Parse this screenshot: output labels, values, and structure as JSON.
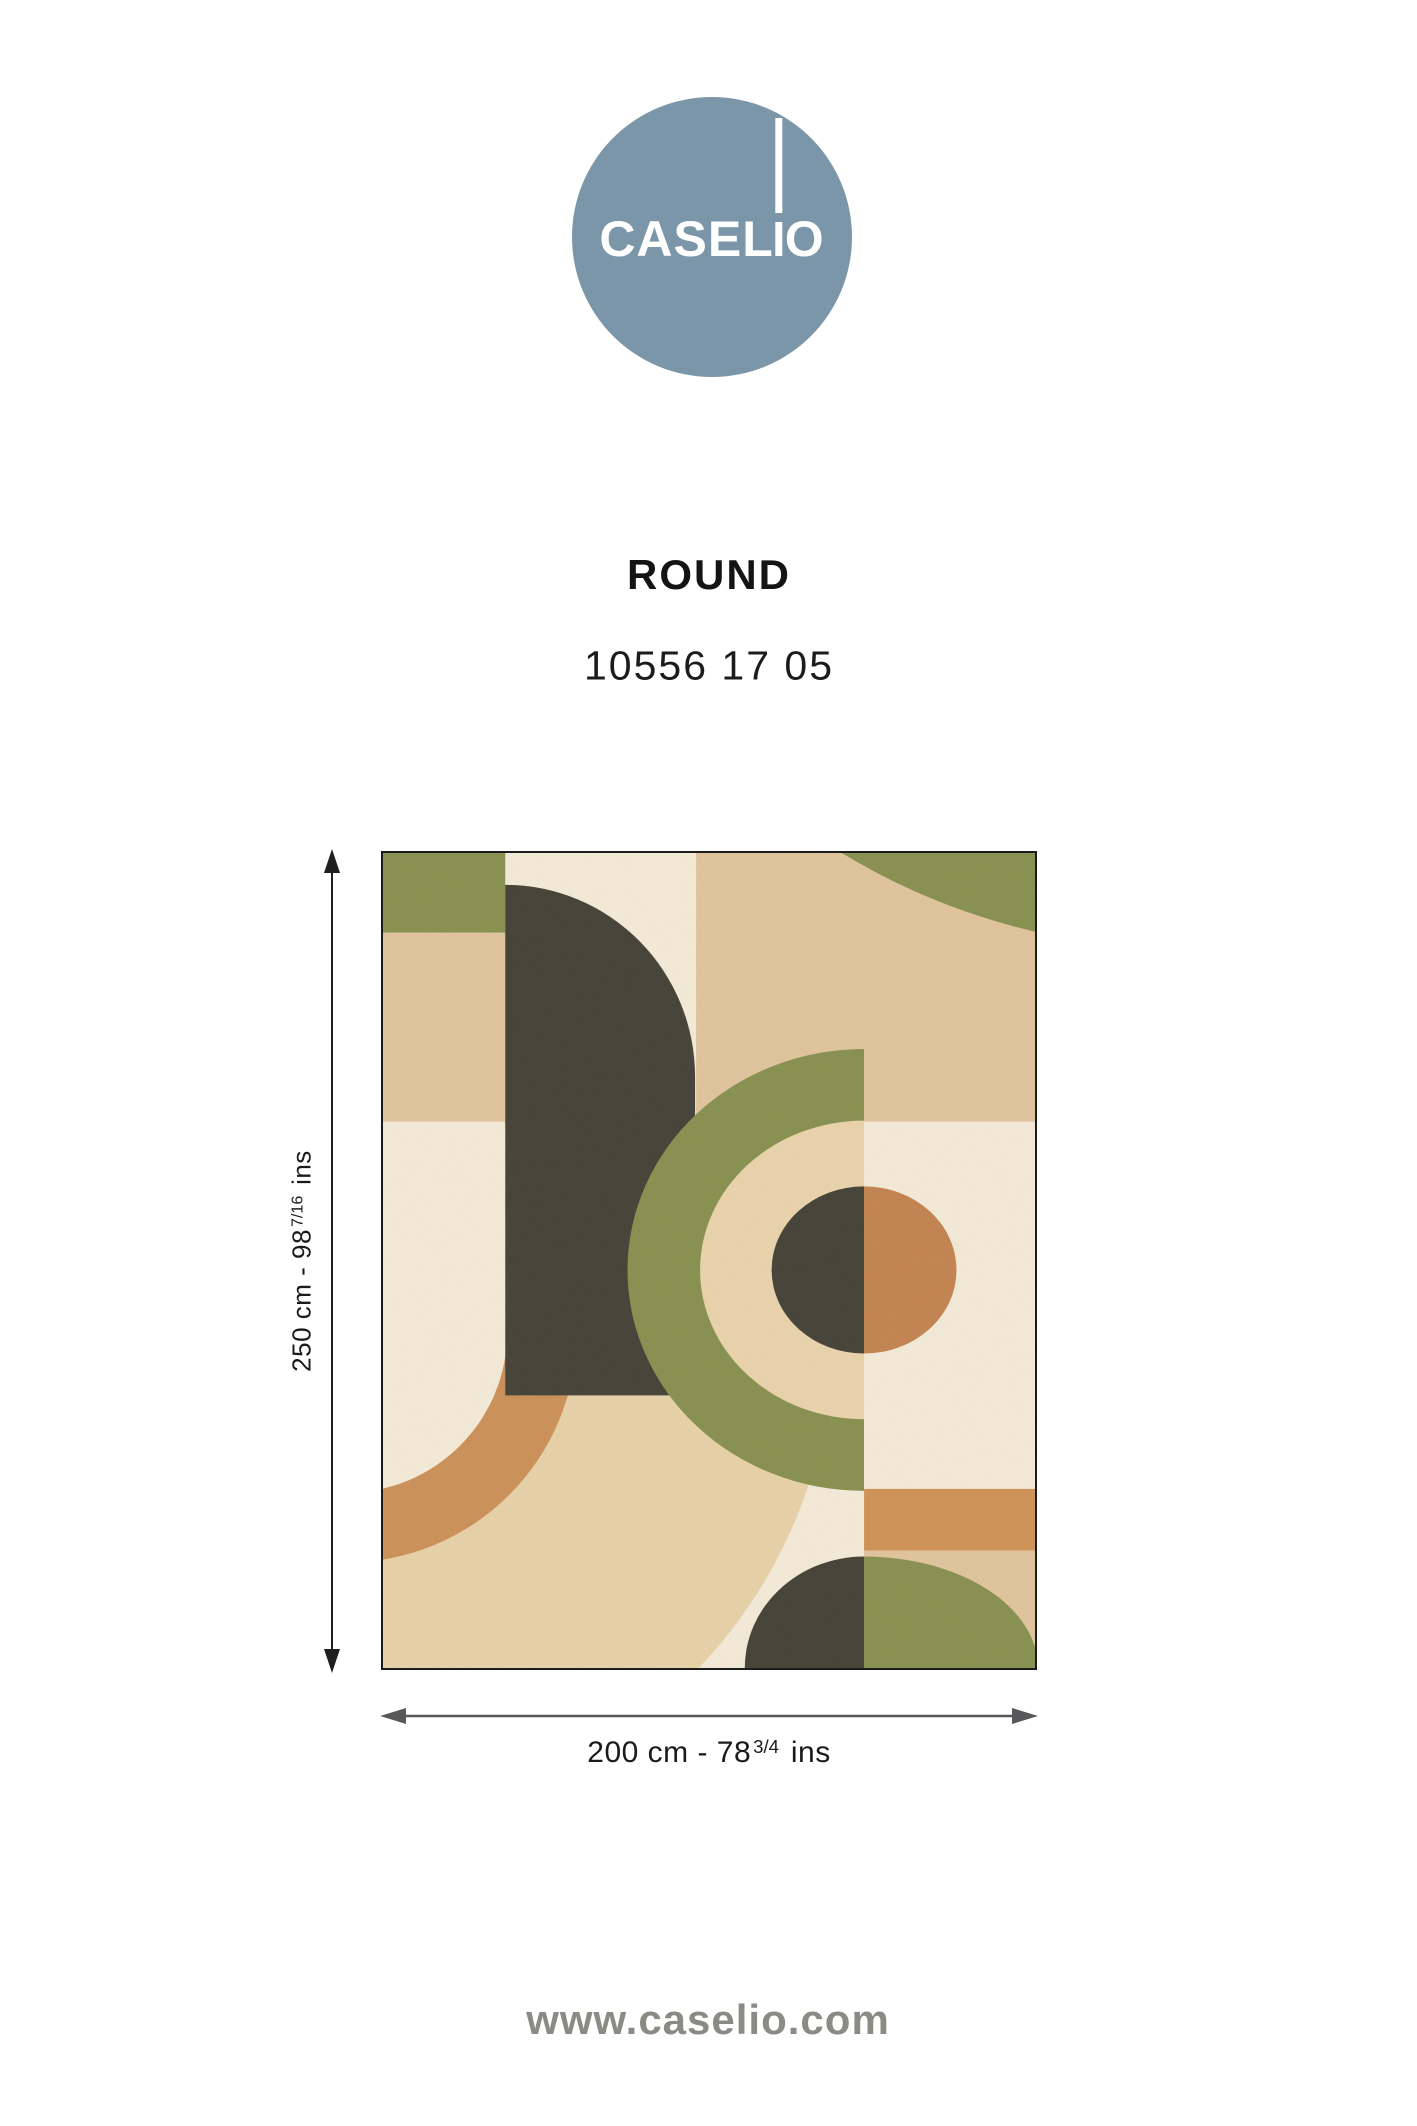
{
  "logo": {
    "brand": "CASELIO",
    "brand_left": "CASEL",
    "brand_right": "O",
    "circle_color": "#7b96a9"
  },
  "header": {
    "title": "ROUND",
    "reference": "10556 17 05"
  },
  "dimensions": {
    "height_label": {
      "prefix": "250 cm - 98",
      "fraction": "7/16",
      "suffix": "ins",
      "full": "250 cm - 98 7/16 ins"
    },
    "width_label": {
      "prefix": "200 cm - 78",
      "fraction": "3/4",
      "suffix": "ins",
      "full": "200 cm - 78 3/4 ins"
    }
  },
  "footer": {
    "website": "www.caselio.com"
  },
  "palette": {
    "cream": "#f2e9d6",
    "tan": "#dfc39c",
    "olive_green": "#87904f",
    "charcoal": "#454237",
    "terracotta_arc": "#cb9058",
    "orange_band": "#cf9257",
    "disc_orange": "#c28350",
    "band_beige": "#e6d0a7",
    "ring_beige": "#e8d2ab",
    "logo_blue": "#7b96a9",
    "footer_gray": "#8b8b86",
    "horizontal_arrow_gray": "#58585a",
    "vertical_arrow_black": "#1f1f1f",
    "pattern_border": "#1c1c1c"
  }
}
